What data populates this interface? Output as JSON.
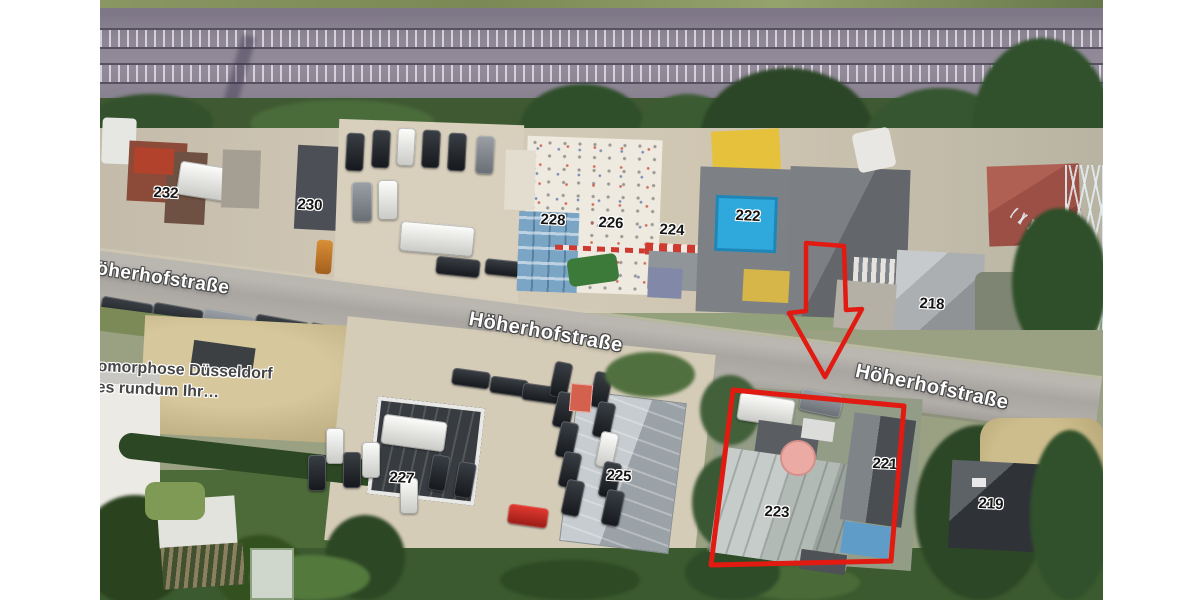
{
  "colors": {
    "annotation_red": "#e11a12",
    "margin_white": "#ffffff"
  },
  "map": {
    "street_labels": [
      {
        "text": "Höherhofstraße"
      },
      {
        "text": "Höherhofstraße"
      },
      {
        "text": "Höherhofstraße"
      }
    ],
    "house_numbers": [
      {
        "label": "232"
      },
      {
        "label": "230"
      },
      {
        "label": "228"
      },
      {
        "label": "226"
      },
      {
        "label": "224"
      },
      {
        "label": "222"
      },
      {
        "label": "218"
      },
      {
        "label": "227"
      },
      {
        "label": "225"
      },
      {
        "label": "223"
      },
      {
        "label": "221"
      },
      {
        "label": "219"
      }
    ],
    "poi_label": {
      "line1": "omorphose Düsseldorf",
      "line2": "es rundum Ihr…"
    },
    "annotations": {
      "arrow_points": "706,243 744,246 746,310 762,309 725,377 689,313 706,311",
      "parcel_points": "633,390 804,406 791,561 611,565"
    }
  }
}
